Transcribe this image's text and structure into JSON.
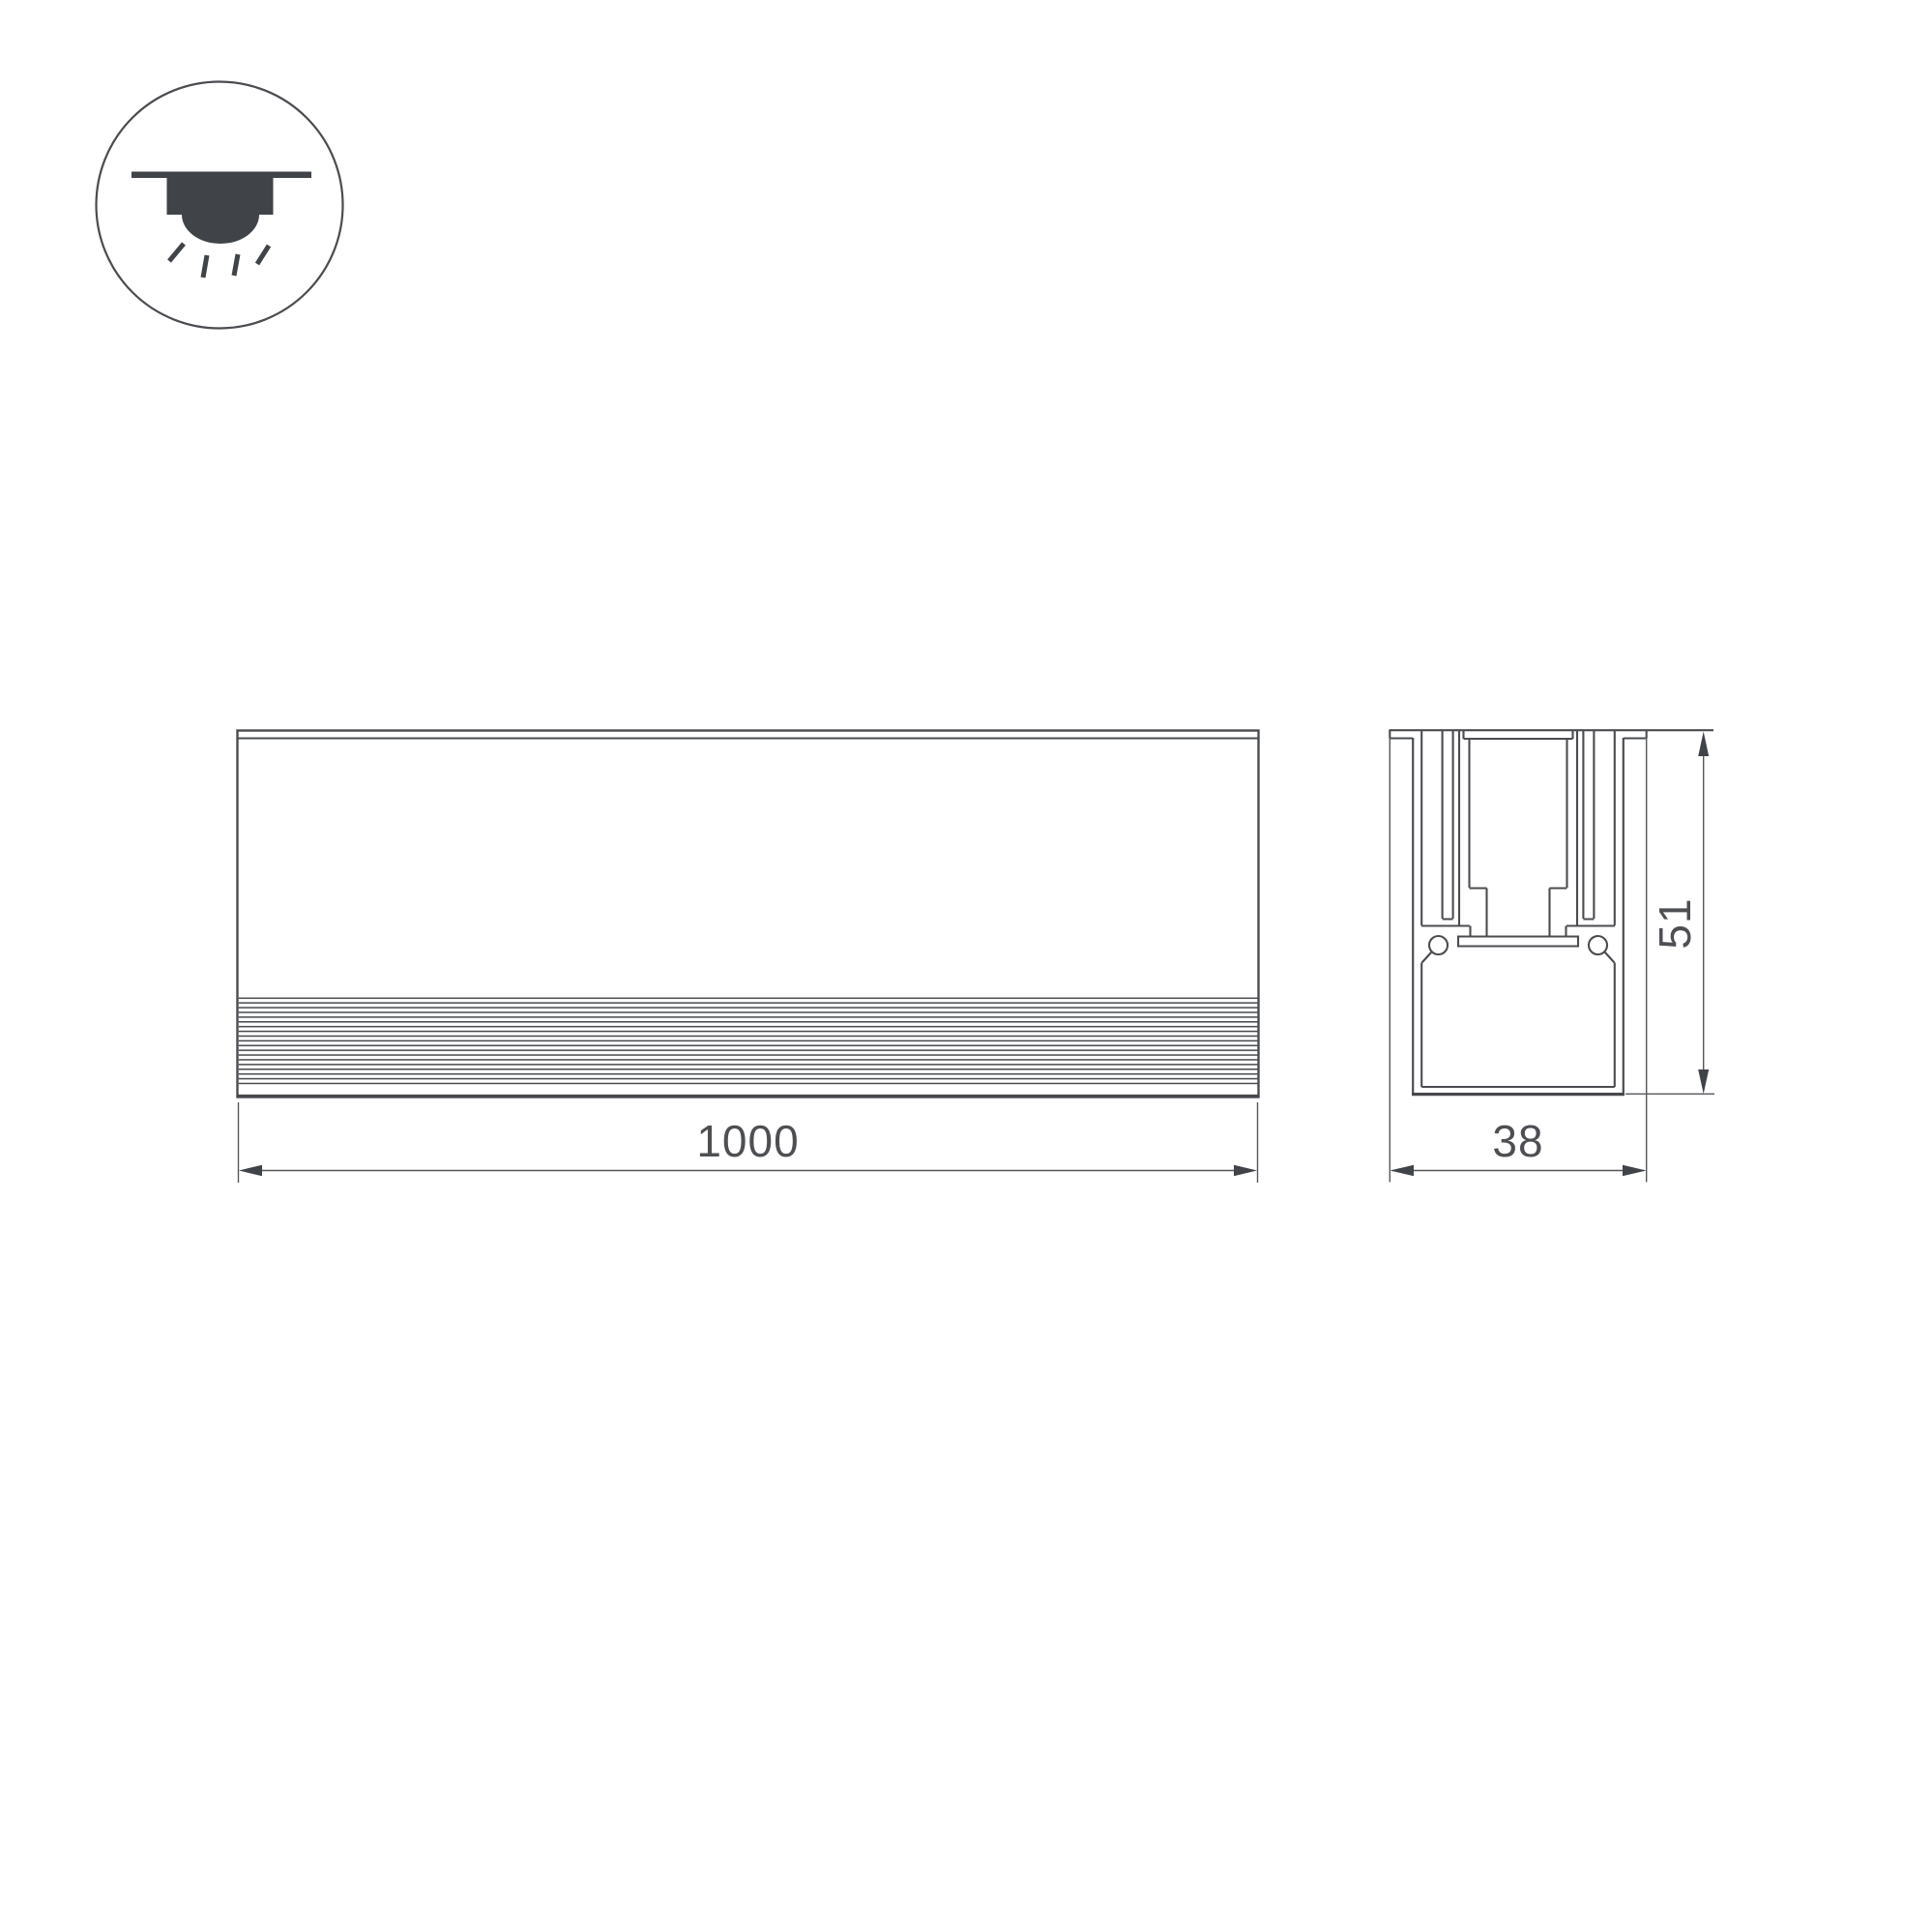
{
  "title": "linear-luminaire-dimension-drawing",
  "colors": {
    "background": "#ffffff",
    "line": "#4a4c50",
    "thin_line": "#55575b",
    "dark_fill": "#404348",
    "text": "#4d4f53"
  },
  "icon": {
    "name": "recessed-downlight",
    "description": "ceiling recessed luminaire with light rays"
  },
  "front_view": {
    "length_dimension": {
      "label": "1000"
    }
  },
  "section_view": {
    "width_dimension": {
      "label": "38"
    },
    "height_dimension": {
      "label": "51"
    }
  }
}
